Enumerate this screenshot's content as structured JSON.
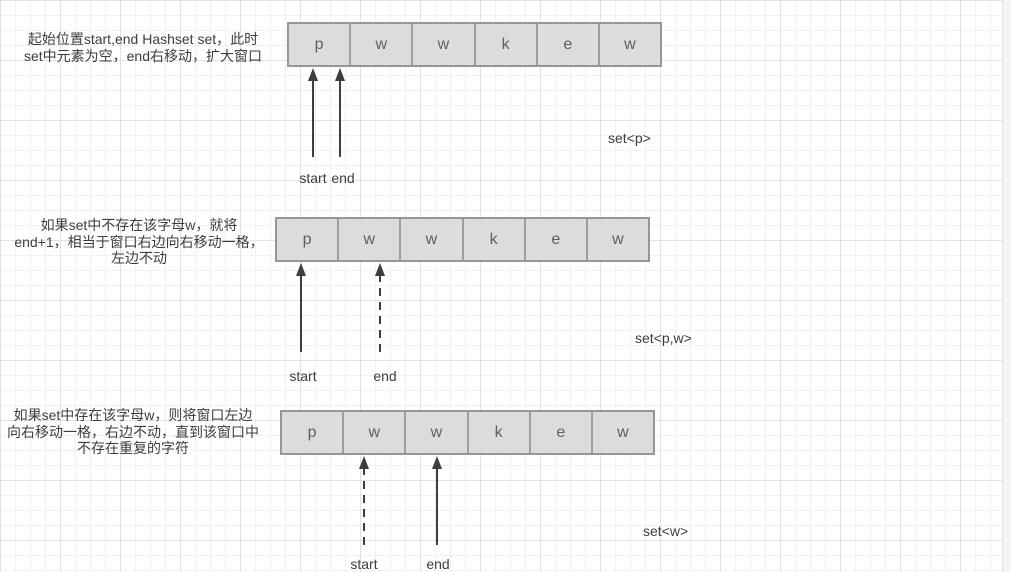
{
  "colors": {
    "cell_fill": "#dcdcdc",
    "cell_border": "#9e9e9e",
    "arrow": "#3d3d3d",
    "text": "#3d3d3d",
    "grid_minor": "#f1f1f1",
    "grid_major": "#e2e2e2"
  },
  "sections": [
    {
      "description_lines": [
        "起始位置start,end Hashset set，此时",
        "set中元素为空，end右移动，扩大窗口"
      ],
      "cells": [
        "p",
        "w",
        "w",
        "k",
        "e",
        "w"
      ],
      "pointers": [
        {
          "label": "start",
          "style": "solid",
          "points_to_cell": 0
        },
        {
          "label": "end",
          "style": "solid",
          "points_to_cell": 0
        }
      ],
      "set_label": "set<p>"
    },
    {
      "description_lines": [
        "如果set中不存在该字母w，就将",
        "end+1，相当于窗口右边向右移动一格，",
        "左边不动"
      ],
      "cells": [
        "p",
        "w",
        "w",
        "k",
        "e",
        "w"
      ],
      "pointers": [
        {
          "label": "start",
          "style": "solid",
          "points_to_cell": 0
        },
        {
          "label": "end",
          "style": "dashed",
          "points_to_cell": 1
        }
      ],
      "set_label": "set<p,w>"
    },
    {
      "description_lines": [
        "如果set中存在该字母w，则将窗口左边",
        "向右移动一格，右边不动，直到该窗口中",
        "不存在重复的字符"
      ],
      "cells": [
        "p",
        "w",
        "w",
        "k",
        "e",
        "w"
      ],
      "pointers": [
        {
          "label": "start",
          "style": "dashed",
          "points_to_cell": 1
        },
        {
          "label": "end",
          "style": "solid",
          "points_to_cell": 2
        }
      ],
      "set_label": "set<w>"
    }
  ]
}
